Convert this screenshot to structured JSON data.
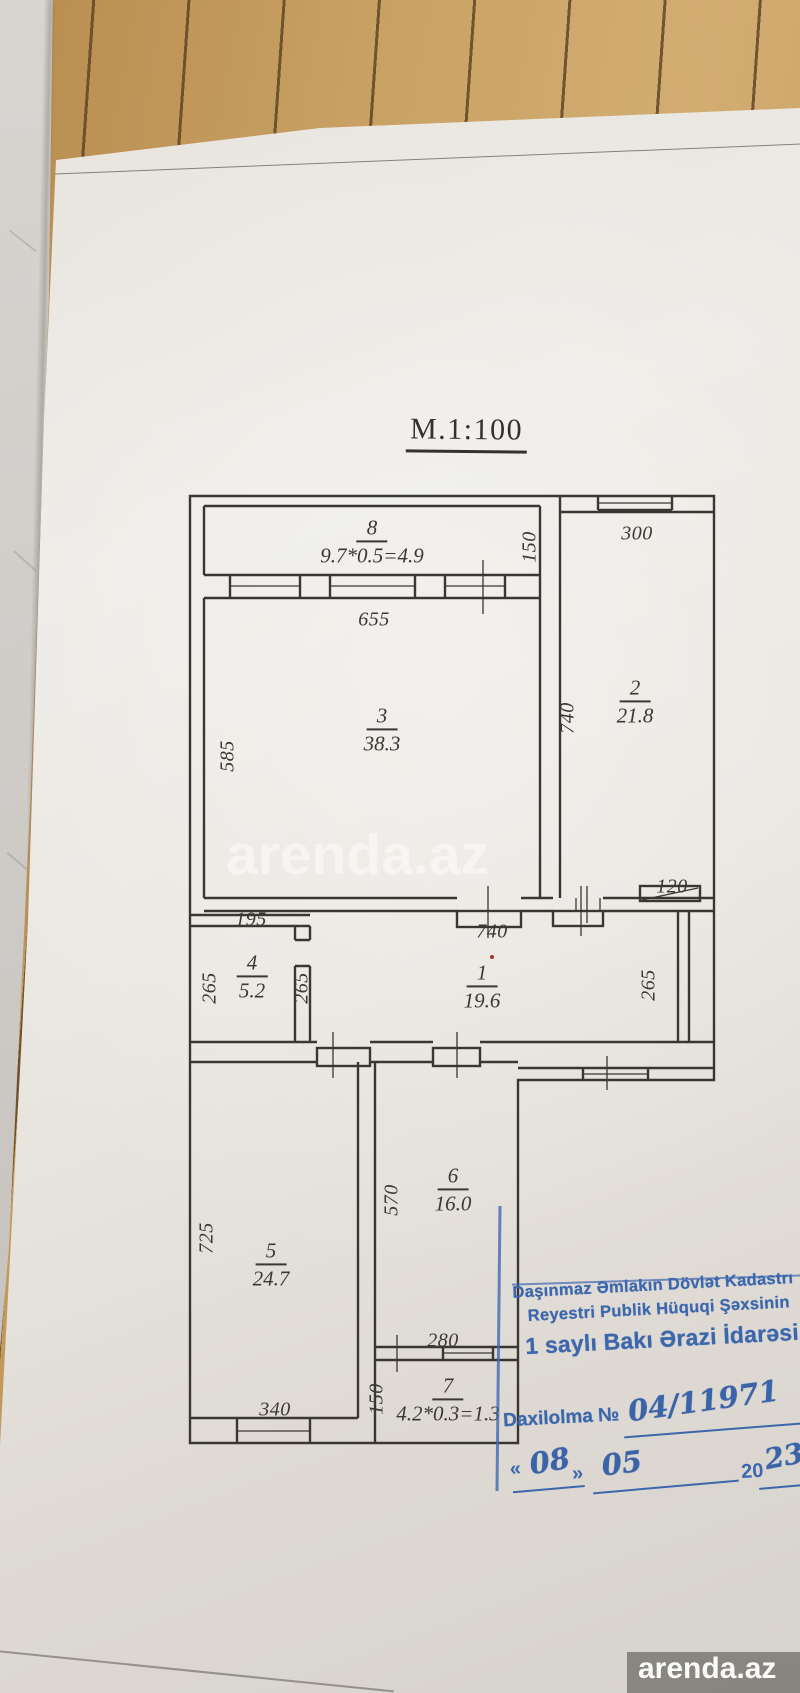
{
  "plan": {
    "title": "M.1:100",
    "rooms": [
      {
        "number": "1",
        "area": "19.6"
      },
      {
        "number": "2",
        "area": "21.8"
      },
      {
        "number": "3",
        "area": "38.3"
      },
      {
        "number": "4",
        "area": "5.2"
      },
      {
        "number": "5",
        "area": "24.7"
      },
      {
        "number": "6",
        "area": "16.0"
      },
      {
        "number": "7",
        "area": "4.2*0.3=1.3"
      },
      {
        "number": "8",
        "area": "9.7*0.5=4.9"
      }
    ],
    "dims": {
      "balcony_depth": "150",
      "room2_width": "300",
      "room3_width": "655",
      "room3_depth": "585",
      "room2_depth": "740",
      "vent_width": "120",
      "room4_width": "195",
      "hall_width": "740",
      "room4_depth": "265",
      "hall_depth_left": "265",
      "hall_depth_right": "265",
      "room5_depth": "725",
      "room5_width": "340",
      "room6_depth": "570",
      "room6_window": "280",
      "room7_depth": "150"
    }
  },
  "stamp": {
    "line1": "Daşınmaz Əmlakın Dövlət Kadastrı",
    "line2": "Reyestri Publik Hüquqi Şəxsinin",
    "line3": "1 saylı Bakı Ərazi İdarəsi",
    "entry_label": "Daxilolma №",
    "entry_number": "04/11971",
    "quote_open": "«",
    "quote_close": "»",
    "day": "08",
    "month": "05",
    "year_prefix": "20",
    "year_suffix": "23"
  },
  "watermarks": {
    "center": "arenda.az",
    "bottom": "arenda.az"
  }
}
